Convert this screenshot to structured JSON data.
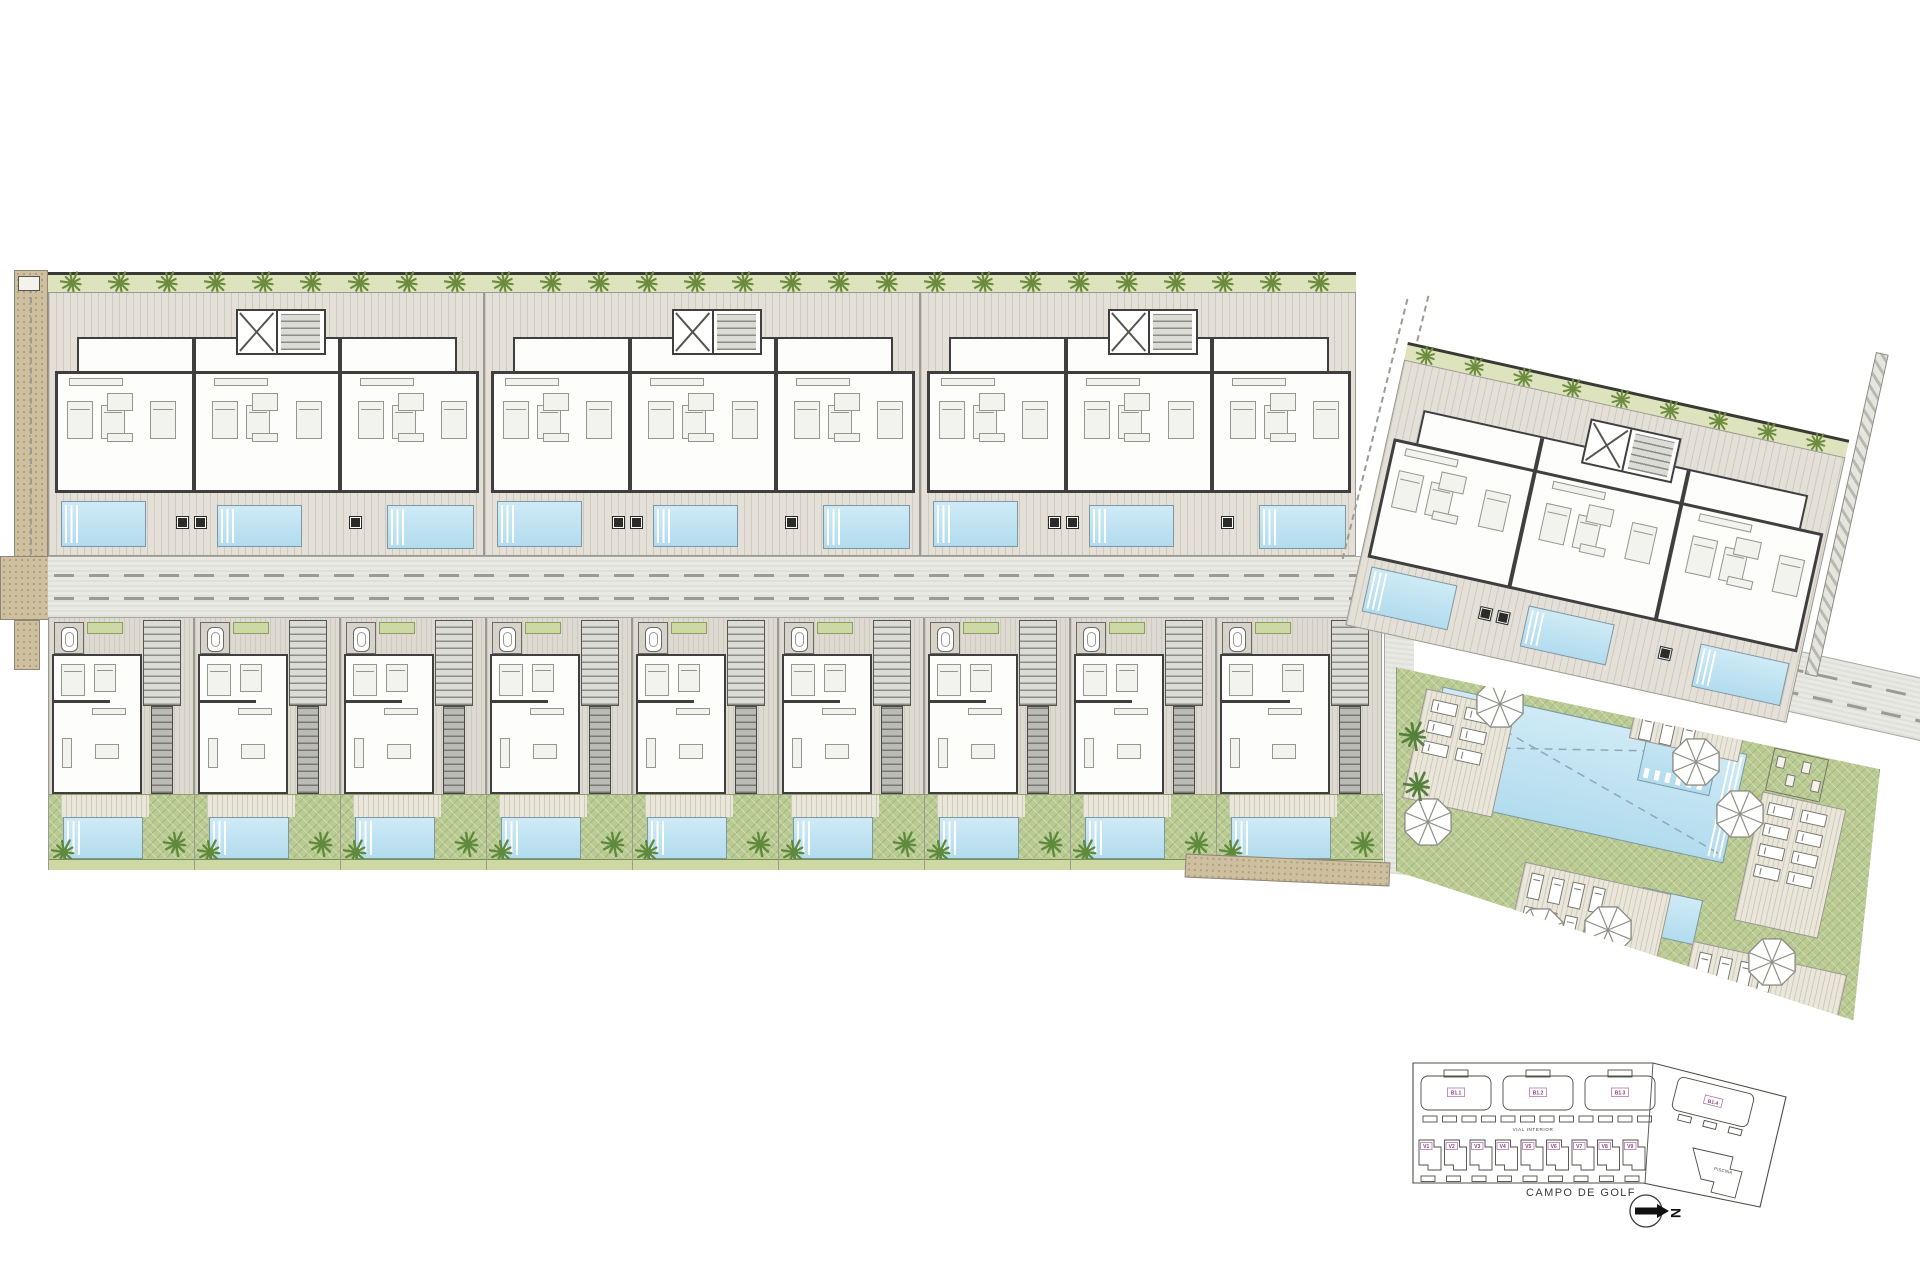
{
  "title": "Residential development master plan",
  "keyplan": {
    "block_labels": [
      "B1.1",
      "B1.2",
      "B1.3"
    ],
    "rotated_block_label": "B1.4",
    "villa_labels": [
      "V1",
      "V2",
      "V3",
      "V4",
      "V5",
      "V6",
      "V7",
      "V8",
      "V9"
    ],
    "road_label": "VIAL INTERIOR",
    "pool_area_label": "PISCINA",
    "golf_label": "CAMPO DE GOLF",
    "north_label": "N"
  },
  "colors": {
    "pool_blue": "#b9dfef",
    "lawn_green": "#b9cb92",
    "hedge_green": "#dde3bc",
    "plant_green": "#6d8c3f",
    "terrace_grey": "#e4e0d8",
    "wall_dark": "#3f3f3f",
    "road_grey": "#e9e9e4",
    "path_tan": "#cec09f",
    "label_magenta": "#8b3f7e"
  }
}
